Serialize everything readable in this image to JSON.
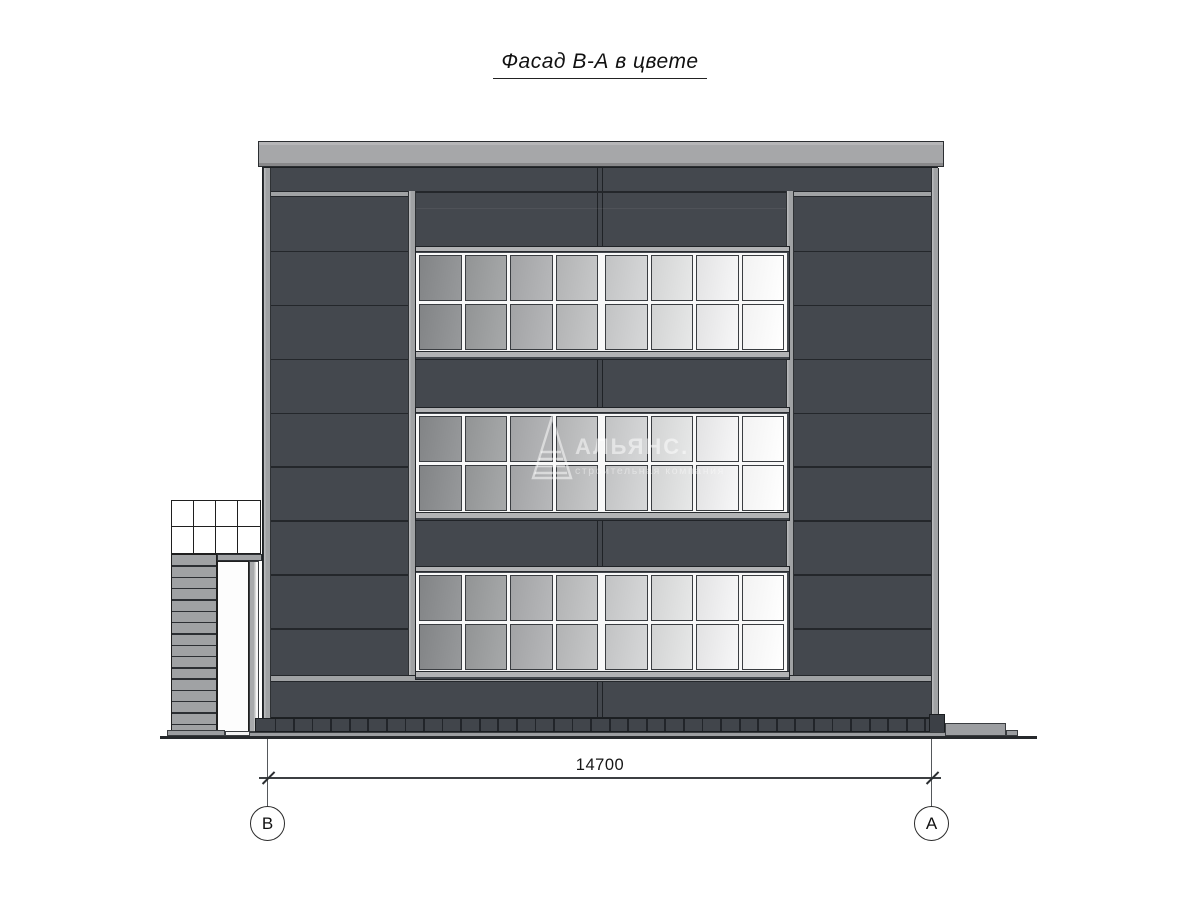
{
  "title": "Фасад В-А в цвете",
  "watermark": {
    "name": "АЛЬЯНС.",
    "subtitle": "строительная компания"
  },
  "dimension": {
    "value": "14700",
    "axis_left": "В",
    "axis_right": "А"
  },
  "facade": {
    "window_bands": 3,
    "window_columns": 8,
    "window_rows": 2,
    "side_panel_joints": 8,
    "stair_slats": 16,
    "plinth_ticks": 36,
    "canopy_cols": 4,
    "canopy_rows": 2,
    "pane_color_start": "#8b8d8f",
    "pane_color_end": "#fbfbfb"
  },
  "colors": {
    "facade-dark": "#44484e",
    "panel-line": "#24272b",
    "pilaster": "#a0a2a4",
    "parapet": "#a6a7a9",
    "plinth": "#41454b",
    "base-strip": "#9c9ea1",
    "mullion": "#f8f8f8",
    "ground": "#26292c",
    "watermark": "rgba(255,255,255,0.5)",
    "watermark-sub": "rgba(255,255,255,0.42)"
  }
}
